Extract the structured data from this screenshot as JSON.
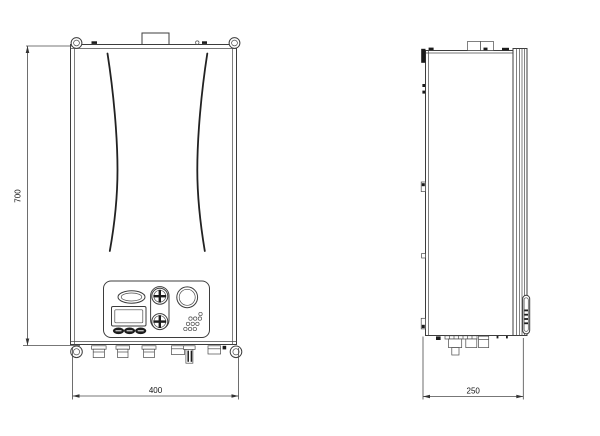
{
  "dims": {
    "height": "700",
    "width": "400",
    "depth": "250"
  },
  "colors": {
    "background": "#ffffff",
    "line": "#3d3d3d",
    "thin_line": "#4a4a4a",
    "dark_detail": "#1c1c1c",
    "dimension_text": "#111111"
  }
}
